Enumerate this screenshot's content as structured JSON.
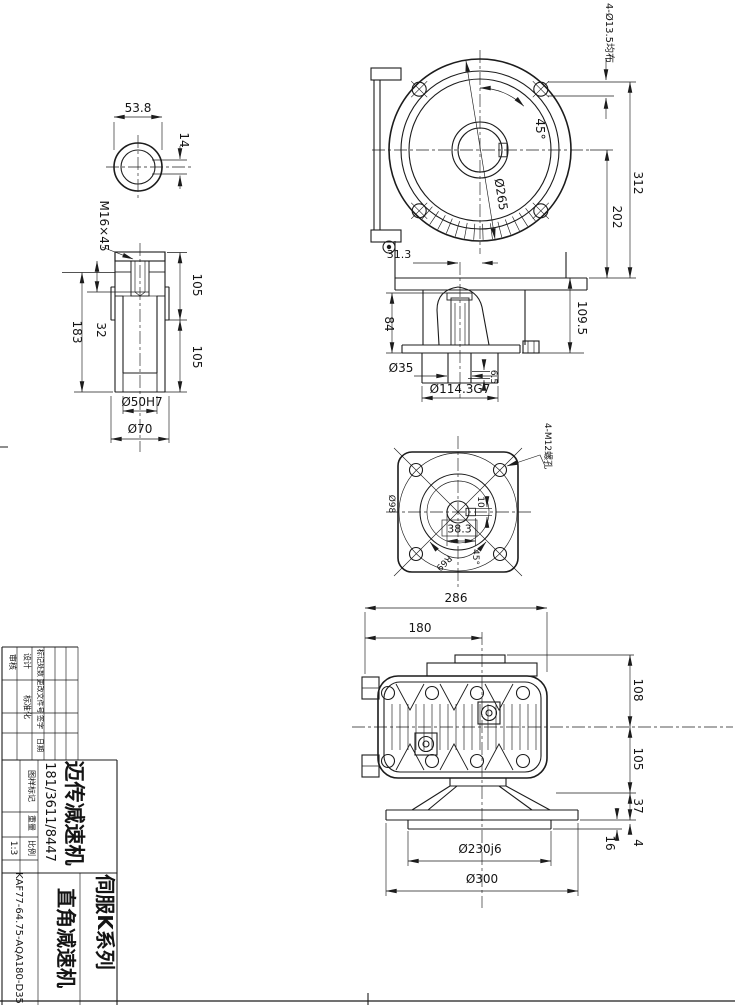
{
  "dims": {
    "ring_width": "53.8",
    "ring_key": "14",
    "bush_thread": "M16×45",
    "bush_len": "183",
    "bush_key": "32",
    "bush_upper": "105",
    "bush_lower": "105",
    "bush_bore": "Ø50H7",
    "bush_od": "Ø70",
    "front_holes": "4-Ø13.5均布",
    "front_angle": "45°",
    "front_bolt_circle": "Ø265",
    "front_height_total": "312",
    "front_height_center": "202",
    "front_offset": "31.3",
    "front_cone": "84",
    "front_base": "109.5",
    "front_step": "6.5",
    "front_shaft": "Ø35",
    "front_spigot": "Ø114.3G7",
    "plan_tapped": "4-M12螺孔",
    "plan_key_box": "38.3",
    "plan_key_width": "10",
    "plan_dia": "Ø98",
    "plan_radius": "R69",
    "plan_angle": "45°",
    "side_width": "286",
    "side_axis": "180",
    "side_h1": "108",
    "side_h2": "105",
    "side_h3": "37",
    "side_h4": "4",
    "side_h5": "16",
    "side_spigot": "Ø230j6",
    "side_flange": "Ø300"
  },
  "title_block": {
    "labels": {
      "audit": "审核",
      "design": "设计",
      "standard": "标准化",
      "mark": "标记处数",
      "change_no": "更改文件号",
      "sign": "签字",
      "date": "日期",
      "drawing_mark": "图样标记",
      "weight": "重量",
      "scale": "比例"
    },
    "scale_value": "1:3",
    "company": "迈传减速机",
    "serial": "181/3611/8447",
    "series": "伺服K系列",
    "product": "直角减速机",
    "model": "KAF77-64.75-AQA180-D35"
  }
}
